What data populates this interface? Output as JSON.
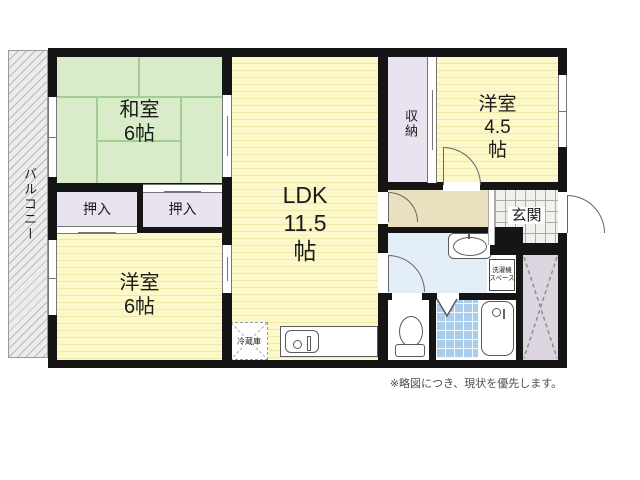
{
  "plan": {
    "balcony": "バルコニー",
    "washitsu": {
      "name": "和室",
      "size": "6帖"
    },
    "ldk": {
      "name": "LDK",
      "size": "11.5",
      "unit": "帖"
    },
    "yoshitsu45": {
      "name": "洋室",
      "size": "4.5",
      "unit": "帖"
    },
    "yoshitsu6": {
      "name": "洋室",
      "size": "6帖"
    },
    "oshiire_left": "押入",
    "oshiire_right": "押入",
    "shuno": "収納",
    "genkan": "玄関",
    "refrigerator": "冷蔵庫",
    "laundry": {
      "line1": "洗濯機",
      "line2": "スペース"
    },
    "note": "※略図につき、現状を優先します。"
  },
  "colors": {
    "wall": "#151515",
    "tatami": "#d9ecc9",
    "tatami-line": "#a3cd92",
    "yellow": "#fcf8c9",
    "yellow-stripe": "#eee8a9",
    "closet": "#e8e3ee",
    "hall": "#eadfbe",
    "washroom": "#e4eef8",
    "bathtile": "#a9cdea",
    "xarea": "#dcd5e0",
    "balcony-bg": "#ececec",
    "balcony-hatch": "#b9b9b9",
    "door": "#666666",
    "text": "#1b1b1b",
    "note-text": "#4c4c4c"
  }
}
